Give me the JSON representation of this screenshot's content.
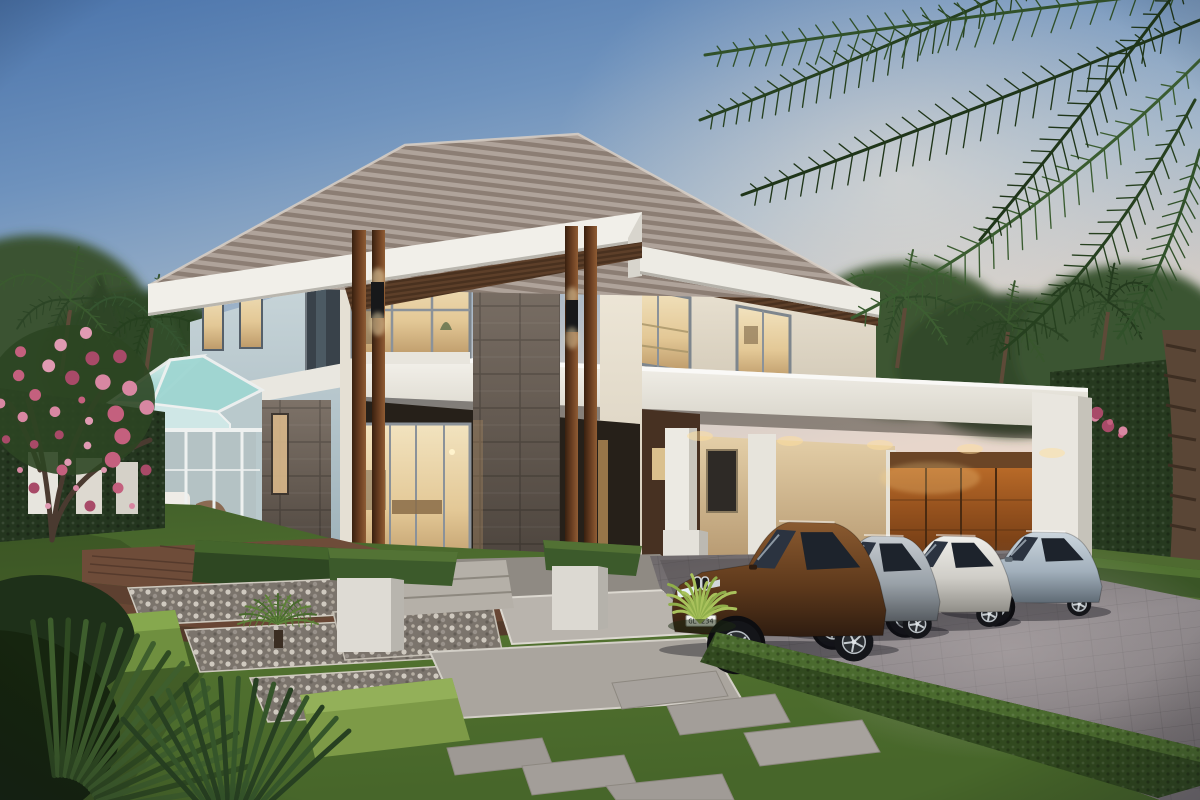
{
  "scene": {
    "type": "3d architectural rendering",
    "subject": "modern two-story luxury villa at dusk",
    "setting": "tropical garden with palms, manicured lawn and stone paver driveway",
    "lighting": "dusk sky fading from blue to warm pink, warm interior lights glowing"
  },
  "sky": {
    "top_color": "#4b74ab",
    "mid_color": "#9fb4c9",
    "horizon_color": "#efdccb"
  },
  "building": {
    "floors": 2,
    "roof": {
      "style": "hip roof with battened tiles",
      "tile_light": "#b4a89f",
      "tile_dark": "#8b7d73",
      "fascia": "#f1efe9"
    },
    "walls": {
      "cream": "#efe7d8",
      "blue_grey": "#c6d4d8",
      "stone_cladding": "#6e655e",
      "timber_columns": "#6b3f22"
    },
    "features": [
      "double-height entry porch with paired timber columns",
      "stone-clad piers",
      "glass sunroom wing",
      "flat-roof carport",
      "timber garage door",
      "black wall sconces",
      "wood slat soffit"
    ]
  },
  "sunroom": {
    "glass_color": "#a8ddd8",
    "frame_color": "#eef1f0",
    "furniture": [
      "white sofa",
      "brown lounge chair",
      "round side table",
      "potted plant"
    ]
  },
  "garage": {
    "door_material": "timber",
    "door_color": "#a85a22"
  },
  "vehicles": [
    {
      "name": "bronze SUV",
      "body_color": "#74451f",
      "plate": "GL 234"
    },
    {
      "name": "silver sedan",
      "body_color": "#aab3ba",
      "plate": "GL 138"
    },
    {
      "name": "white sportback",
      "body_color": "#e8e7e3",
      "plate": "GL 045"
    },
    {
      "name": "ice-blue compact",
      "body_color": "#b7c6d2",
      "plate": ""
    }
  ],
  "landscape": {
    "lawn_color": "#53732f",
    "hedge_color": "#31491f",
    "driveway_color": "#8a8486",
    "deck_color": "#6e4c39",
    "elements": [
      "overhanging palm fronds",
      "background palm trees",
      "conifers",
      "plumeria tree with pink flowers",
      "trimmed hedges",
      "grey stepping stones",
      "gravel pads",
      "pebble strips",
      "timber deck steps",
      "white planter boxes",
      "cycad rosette",
      "fan palms"
    ]
  }
}
